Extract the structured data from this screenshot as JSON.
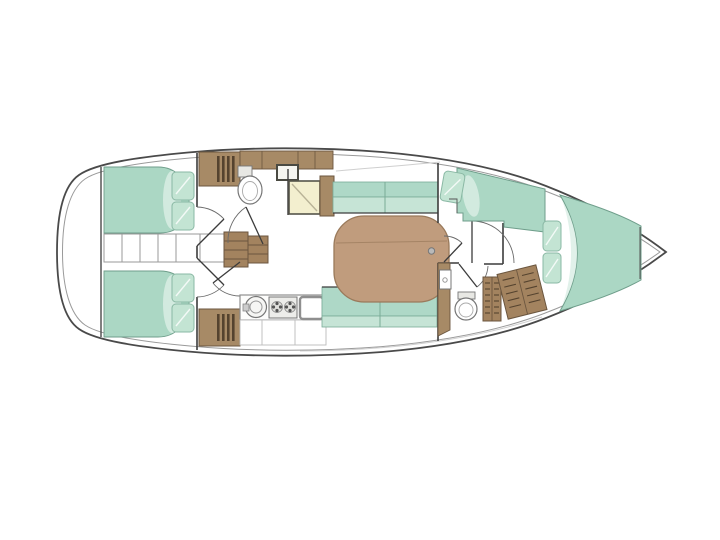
{
  "diagram": {
    "type": "yacht-interior-floor-plan",
    "orientation": "bow-right-stern-left",
    "visible_text": [],
    "rooms": [
      {
        "name": "aft-cabin-port",
        "furniture": [
          "double-berth",
          "pillows",
          "wardrobe-with-vent-grille"
        ]
      },
      {
        "name": "aft-cabin-starboard",
        "furniture": [
          "double-berth",
          "pillows",
          "wardrobe-with-vent-grille"
        ]
      },
      {
        "name": "engine-compartment",
        "furniture": [
          "slatted-hatch"
        ]
      },
      {
        "name": "companionway",
        "furniture": [
          "wooden-steps"
        ]
      },
      {
        "name": "aft-head",
        "furniture": [
          "toilet",
          "sink",
          "overhead-lockers",
          "door"
        ]
      },
      {
        "name": "nav-station",
        "furniture": [
          "chart-table",
          "side-cabinet"
        ]
      },
      {
        "name": "galley",
        "furniture": [
          "round-sink",
          "two-burner-stove",
          "square-sink",
          "under-counter-cabinets",
          "wardrobe-with-vent-grille"
        ]
      },
      {
        "name": "salon",
        "furniture": [
          "dining-table",
          "settee-port",
          "settee-starboard",
          "mast-post"
        ]
      },
      {
        "name": "forward-guest-berth",
        "furniture": [
          "pullman-berth",
          "pillow",
          "steps"
        ]
      },
      {
        "name": "forward-head",
        "furniture": [
          "toilet",
          "sink",
          "slatted-lockers",
          "door"
        ]
      },
      {
        "name": "bow-cabin",
        "furniture": [
          "v-berth",
          "pillows"
        ]
      },
      {
        "name": "forepeak",
        "furniture": [
          "anchor-locker"
        ]
      }
    ]
  },
  "colors": {
    "bg": "#ffffff",
    "hullStroke": "#4a4a4a",
    "innerStroke": "#9a9a9a",
    "rail": "#cfcfcf",
    "wall": "#3c3c3c",
    "arc": "#6a6a6a",
    "wood": "#a78a66",
    "woodDark": "#6b563f",
    "woodSlat": "#55432f",
    "steps": "#a3835f",
    "table": "#c09c7d",
    "tableStroke": "#9a7a5b",
    "green": "#abd7c4",
    "greenSeat": "#aed8c7",
    "greenSeatLight": "#c6e4d6",
    "greenStroke": "#79ab97",
    "bedStroke": "#6f9e8b",
    "bedFold": "#dcefe6",
    "pillow": "#c3e4d3",
    "pillowStroke": "#8ab8a4",
    "cream": "#f3efcf",
    "creamStroke": "#55544a",
    "creamLine": "#b9b397",
    "fixture": "#777777",
    "fixtureLight": "#aaaaaa",
    "floor": "#ffffff",
    "mast": "#b9b9b9"
  }
}
